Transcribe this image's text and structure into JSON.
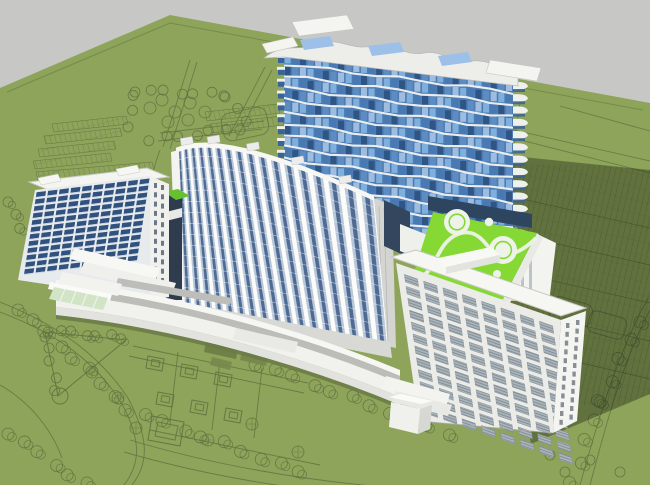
{
  "scene": {
    "description": "3D architectural massing render of a mixed residential complex on a landscaped site plan",
    "view": "aerial-axonometric",
    "shadow_direction": "cast-to-lower-right"
  },
  "colors": {
    "sky": "#c7c8c5",
    "ground": "#8da45a",
    "plan_line": "#5f7040",
    "shadow": "#000000",
    "shadow_opacity": "0.30",
    "white": "#f4f4f1",
    "white_mid": "#e6e6e2",
    "white_dark": "#c6c6c2",
    "gray_face": "#bcbcb8",
    "glass_dark": "#2f5585",
    "glass_mid": "#4979b2",
    "glass_light": "#7fb0dd",
    "tower_base_glass": "#2e4560",
    "window_navy": "#31527e",
    "louver_base": "#aab4bb",
    "louver_line": "#717c85",
    "podium_green": "#86d934",
    "podium_green_dark": "#65c22e",
    "glass_canopy": "#d2e4c6",
    "connector_dark": "#2f3c4e",
    "pad_white": "#edf3e8",
    "plaza": "#d8d8d4"
  },
  "buildings": {
    "tower": {
      "name": "wave-balcony-tower",
      "floors": 14,
      "window_columns": 30,
      "balconies_per_side": 13,
      "roof_skylights": 3
    },
    "curved_slab": {
      "name": "curved-slab-block",
      "floors": 15,
      "bays": 17,
      "roof_stubs": 5
    },
    "left_slab": {
      "name": "left-slab-block",
      "floors": 12,
      "window_columns": 10
    },
    "right_slab": {
      "name": "right-end-slab",
      "floors": 12,
      "window_columns": 8
    },
    "podium": {
      "name": "green-roof-podium",
      "large_circles": 2,
      "small_circles": 2,
      "features": [
        "helipad-circles",
        "s-curve-path",
        "roof-pavilion"
      ]
    },
    "arc_building": {
      "name": "curved-low-rise-gallery",
      "tiers": 2,
      "left_end": "stepped-canopy-with-glass-atrium",
      "right_end": "stepped-terraces"
    },
    "connector": {
      "name": "dark-glass-connector",
      "roof": "green"
    }
  },
  "site": {
    "zones": [
      "tree-ring-garden-nw",
      "parking-rows-nw",
      "triangle-park-sw",
      "courtyard-plan-s",
      "parking-field-e",
      "road-loops"
    ],
    "tree_symbol": "circle-outline",
    "parking_symbol": "hatched-stall-rows"
  }
}
